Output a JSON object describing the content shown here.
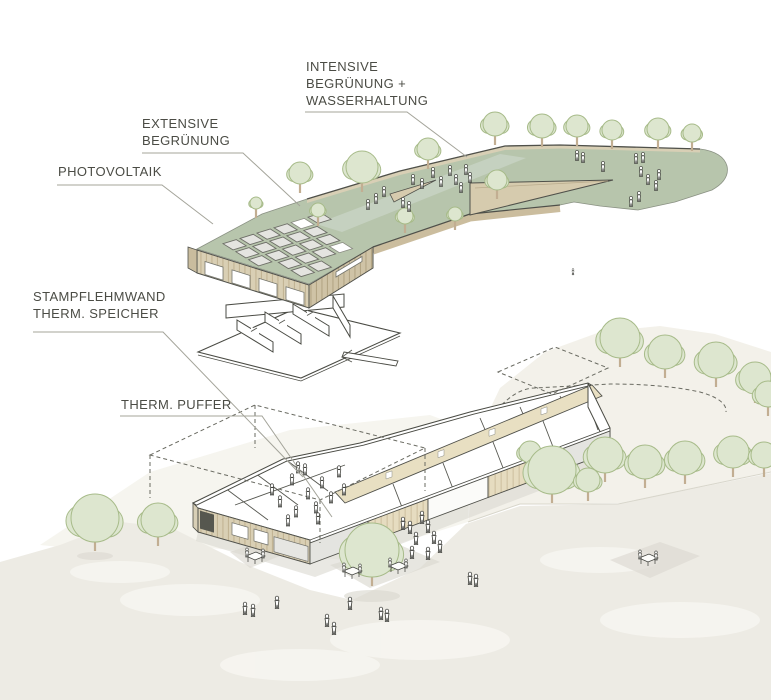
{
  "diagram": {
    "type": "architectural-exploded-axonometric",
    "annotations": [
      {
        "id": "intensive-begruenung",
        "lines": [
          "INTENSIVE",
          "BEGRÜNUNG +",
          "WASSERHALTUNG"
        ],
        "x": 306,
        "y": 58,
        "leader": [
          [
            305,
            112
          ],
          [
            407,
            112
          ],
          [
            467,
            157
          ]
        ]
      },
      {
        "id": "extensive-begruenung",
        "lines": [
          "EXTENSIVE",
          "BEGRÜNUNG"
        ],
        "x": 142,
        "y": 115,
        "leader": [
          [
            142,
            153
          ],
          [
            243,
            153
          ],
          [
            300,
            206
          ]
        ]
      },
      {
        "id": "photovoltaik",
        "lines": [
          "PHOTOVOLTAIK"
        ],
        "x": 58,
        "y": 163,
        "leader": [
          [
            57,
            185
          ],
          [
            162,
            185
          ],
          [
            213,
            224
          ]
        ]
      },
      {
        "id": "stampflehmwand",
        "lines": [
          "STAMPFLEHMWAND",
          "THERM. SPEICHER"
        ],
        "x": 33,
        "y": 288,
        "leader": [
          [
            33,
            332
          ],
          [
            163,
            332
          ],
          [
            303,
            477
          ]
        ]
      },
      {
        "id": "therm-puffer",
        "lines": [
          "THERM. PUFFER"
        ],
        "x": 121,
        "y": 396,
        "leader": [
          [
            120,
            416
          ],
          [
            262,
            416
          ],
          [
            332,
            517
          ]
        ]
      }
    ]
  },
  "colors": {
    "label_text": "#4b4c45",
    "leader_line": "#a4a49a",
    "line_dark": "#4a4b44",
    "roof_green": "#b7c5ac",
    "path_green": "#c7d1c2",
    "pv_fill": "#e4e4e0",
    "pv_stroke": "#6e6f68",
    "wood_light": "#d9cfb4",
    "wood_mid": "#cfc3a6",
    "wood_wing": "#e6dcc0",
    "band_tan": "#e8dfc2",
    "tree_fill": "#dde6cf",
    "tree_stroke": "#a7bb89",
    "trunk": "#c2ae92",
    "ground": "#edebe4",
    "hill": "#f3f1ea",
    "shadow": "#dbd9d1",
    "dash": "#6a6b62",
    "figure_fill": "#ffffff",
    "figure_stroke": "#3c3d38"
  },
  "scene": {
    "pv_grid": {
      "origin": [
        206,
        249
      ],
      "u": [
        17,
        -5.3
      ],
      "v": [
        12.8,
        8
      ],
      "rows": 6,
      "cols": 9,
      "frac": 0.78,
      "clip": [
        [
          199,
          249
        ],
        [
          306,
          201
        ],
        [
          371,
          246
        ],
        [
          310,
          283
        ]
      ],
      "slots": [
        [
          0,
          5
        ],
        [
          3,
          5
        ]
      ]
    },
    "deck_people": [
      [
        413,
        180
      ],
      [
        422,
        184
      ],
      [
        433,
        173
      ],
      [
        441,
        182
      ],
      [
        450,
        171
      ],
      [
        456,
        180
      ],
      [
        461,
        188
      ],
      [
        466,
        170
      ],
      [
        470,
        178
      ],
      [
        403,
        203
      ],
      [
        409,
        207
      ],
      [
        384,
        192
      ],
      [
        376,
        199
      ],
      [
        368,
        205
      ]
    ],
    "blob_people": [
      [
        577,
        156
      ],
      [
        583,
        158
      ],
      [
        603,
        167
      ],
      [
        636,
        159
      ],
      [
        643,
        158
      ],
      [
        641,
        172
      ],
      [
        648,
        180
      ],
      [
        656,
        186
      ],
      [
        639,
        197
      ],
      [
        631,
        202
      ],
      [
        659,
        175
      ]
    ],
    "interior_people": [
      [
        272,
        490
      ],
      [
        280,
        502
      ],
      [
        292,
        480
      ],
      [
        296,
        512
      ],
      [
        305,
        470
      ],
      [
        308,
        494
      ],
      [
        316,
        508
      ],
      [
        322,
        483
      ],
      [
        331,
        498
      ],
      [
        298,
        468
      ],
      [
        288,
        521
      ],
      [
        318,
        519
      ],
      [
        339,
        472
      ],
      [
        344,
        490
      ]
    ],
    "ground_people": [
      [
        245,
        609
      ],
      [
        253,
        611
      ],
      [
        277,
        603
      ],
      [
        327,
        621
      ],
      [
        334,
        629
      ],
      [
        350,
        604
      ],
      [
        381,
        614
      ],
      [
        387,
        616
      ],
      [
        470,
        579
      ],
      [
        476,
        581
      ],
      [
        403,
        524
      ],
      [
        410,
        528
      ],
      [
        416,
        539
      ],
      [
        428,
        527
      ],
      [
        434,
        538
      ],
      [
        412,
        553
      ],
      [
        428,
        554
      ],
      [
        440,
        547
      ],
      [
        422,
        518
      ]
    ],
    "lone_figure": [
      573,
      272
    ],
    "trees_top": [
      [
        256,
        203,
        6
      ],
      [
        318,
        210,
        7
      ],
      [
        405,
        216,
        8
      ],
      [
        455,
        214,
        7
      ],
      [
        300,
        173,
        11
      ],
      [
        362,
        167,
        16
      ],
      [
        428,
        149,
        11
      ],
      [
        497,
        180,
        10
      ],
      [
        495,
        124,
        12
      ],
      [
        542,
        126,
        12
      ],
      [
        577,
        126,
        11
      ],
      [
        612,
        130,
        10
      ],
      [
        658,
        129,
        11
      ],
      [
        692,
        133,
        9
      ]
    ],
    "trees_hill_back": [
      [
        620,
        338,
        20
      ],
      [
        665,
        352,
        17
      ],
      [
        716,
        360,
        18
      ],
      [
        755,
        378,
        16
      ],
      [
        768,
        394,
        13
      ]
    ],
    "trees_hill_front": [
      [
        530,
        452,
        11
      ],
      [
        552,
        470,
        24
      ],
      [
        605,
        455,
        18
      ],
      [
        645,
        462,
        17
      ],
      [
        685,
        458,
        17
      ],
      [
        733,
        452,
        16
      ],
      [
        764,
        455,
        13
      ],
      [
        588,
        480,
        12
      ]
    ],
    "trees_ground": [
      [
        95,
        518,
        24
      ],
      [
        158,
        520,
        17
      ],
      [
        372,
        550,
        27
      ]
    ],
    "tables": [
      [
        255,
        558
      ],
      [
        352,
        573
      ],
      [
        398,
        568
      ],
      [
        648,
        560
      ]
    ]
  }
}
